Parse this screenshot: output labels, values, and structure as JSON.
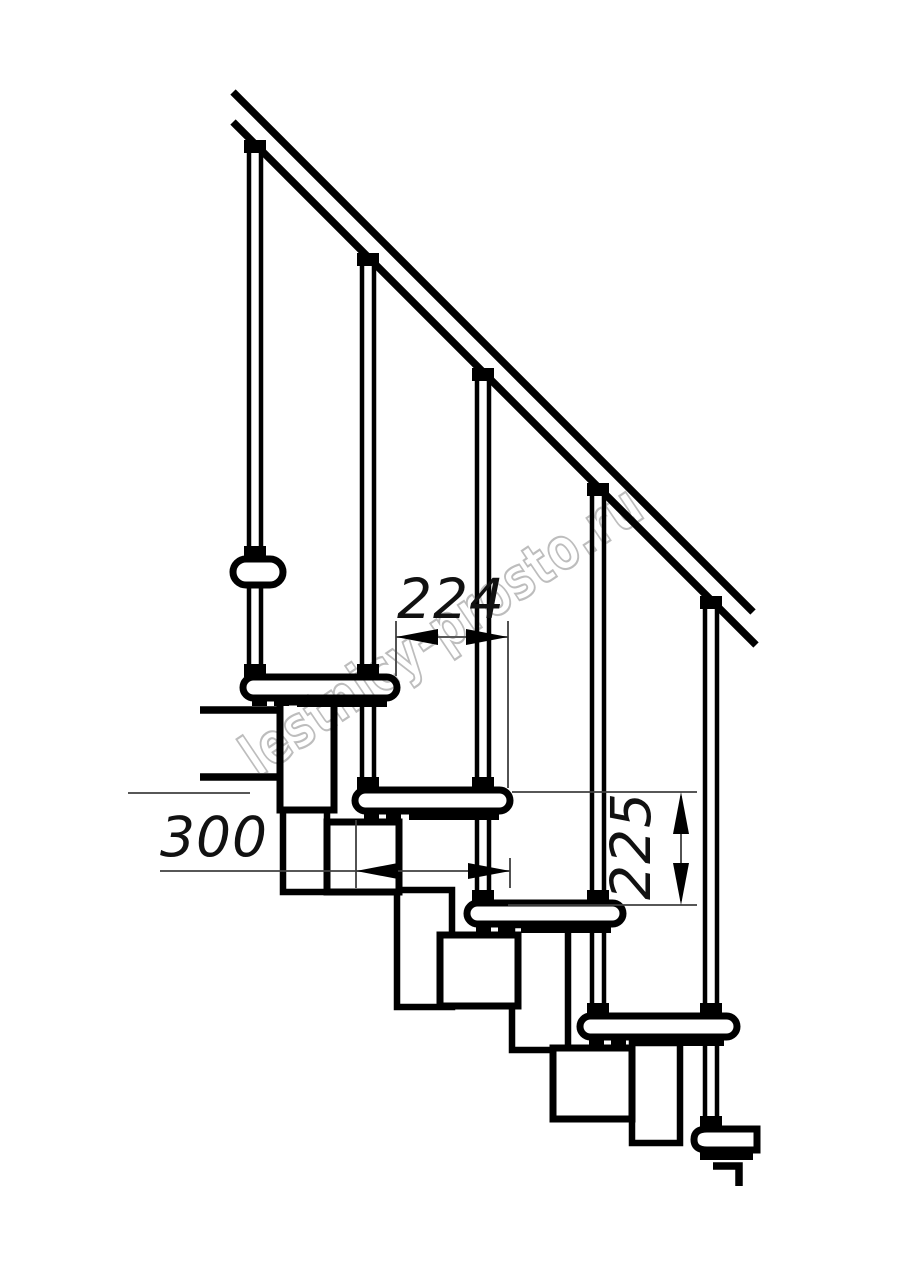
{
  "drawing": {
    "kind": "modular-staircase-side-elevation"
  },
  "dimensions": {
    "d224": {
      "value": "224"
    },
    "d300": {
      "value": "300"
    },
    "d225": {
      "value": "225"
    }
  },
  "watermark": {
    "text": "lestnicy-prosto.ru",
    "color": "#bdbdbd"
  },
  "colors": {
    "line": "#000000",
    "dimension": "#3f3f3f",
    "background": "#ffffff"
  }
}
